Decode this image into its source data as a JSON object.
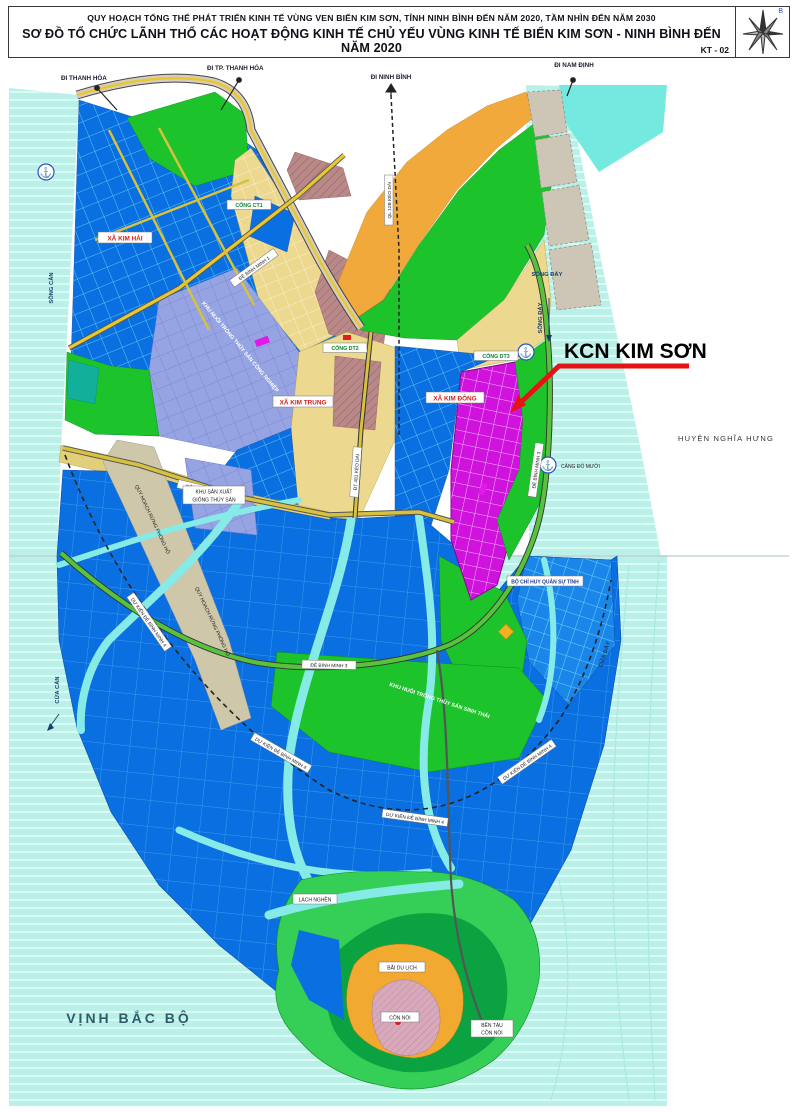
{
  "header": {
    "title_line1": "QUY HOẠCH TỔNG THỂ PHÁT TRIỂN KINH TẾ VÙNG VEN BIỂN KIM SƠN, TỈNH NINH BÌNH ĐẾN NĂM 2020, TẦM NHÌN ĐẾN NĂM 2030",
    "title_line2": "SƠ ĐỒ TỔ CHỨC LÃNH THỔ CÁC HOẠT ĐỘNG KINH TẾ CHỦ YẾU VÙNG KINH TẾ BIỂN KIM SƠN - NINH BÌNH ĐẾN NĂM 2020",
    "sheet_code": "KT - 02",
    "compass_north": "B"
  },
  "map": {
    "callout": {
      "kcn": "KCN KIM SƠN"
    },
    "directions": {
      "thanh_hoa": "ĐI THANH HÓA",
      "tp_thanh_hoa": "ĐI TP. THANH HÓA",
      "ninh_binh": "ĐI NINH BÌNH",
      "nam_dinh": "ĐI NAM ĐỊNH"
    },
    "water": {
      "song_can": "SÔNG CÀN",
      "song_day": "SÔNG ĐÁY",
      "cua_can": "CỬA CÀN",
      "cua_day": "CỬA ĐÁY",
      "lach_nghen": "LẠCH NGHỀN",
      "vinh_bac_bo": "VỊNH BẮC BỘ"
    },
    "communes": {
      "kim_hai": "XÃ KIM HẢI",
      "kim_trung": "XÃ KIM TRUNG",
      "kim_dong": "XÃ KIM ĐÔNG"
    },
    "gates": {
      "ct1": "CỐNG CT1",
      "dt2": "CỐNG DT2",
      "dt3": "CỐNG DT3"
    },
    "roads": {
      "de_bm1": "ĐÊ BÌNH MINH 1",
      "de_bm2": "ĐÊ BÌNH MINH 2",
      "de_bm3": "ĐÊ BÌNH MINH 3",
      "de_bm4_planned": "DỰ KIẾN ĐÊ BÌNH MINH 4",
      "ql12b": "QL 12B KÉO DÀI",
      "dt481": "ĐT 481 KÉO DÀI"
    },
    "zones": {
      "khu_san_xuat_line1": "KHU SẢN XUẤT",
      "khu_san_xuat_line2": "GIỐNG THỦY SẢN",
      "rung_phong_ho": "QUY HOẠCH RỪNG PHÒNG HỘ",
      "nuoi_trong_cn": "KHU NUÔI TRỒNG THỦY SẢN CÔNG NGHIỆP",
      "nuoi_trong_st": "KHU NUÔI TRỒNG THỦY SẢN SINH THÁI",
      "bo_chi_huy": "BỘ CHỈ HUY QUÂN SỰ TỈNH",
      "cang_do_muoi": "CẢNG ĐÒ MƯỜI",
      "bai_du_lich": "BÃI DU LỊCH",
      "con_noi": "CỒN NỔI",
      "ben_tau_line1": "BẾN TÀU",
      "ben_tau_line2": "CỒN NỔI"
    },
    "neighbors": {
      "huyen_nghia_hung": "HUYỆN NGHĨA HƯNG"
    }
  },
  "colors": {
    "sea": "#b9f1e9",
    "aquaculture_blue": "#0a6fe0",
    "industrial_magenta": "#cf13dd",
    "forest_green": "#1dc32b",
    "farmland_khaki": "#ecd98f",
    "urban_maroon": "#b98989",
    "aquaculture_periwinkle": "#96a4e4",
    "coast_orange": "#f2a93c",
    "island_orange": "#f2a930",
    "callout_red": "#e51313"
  }
}
